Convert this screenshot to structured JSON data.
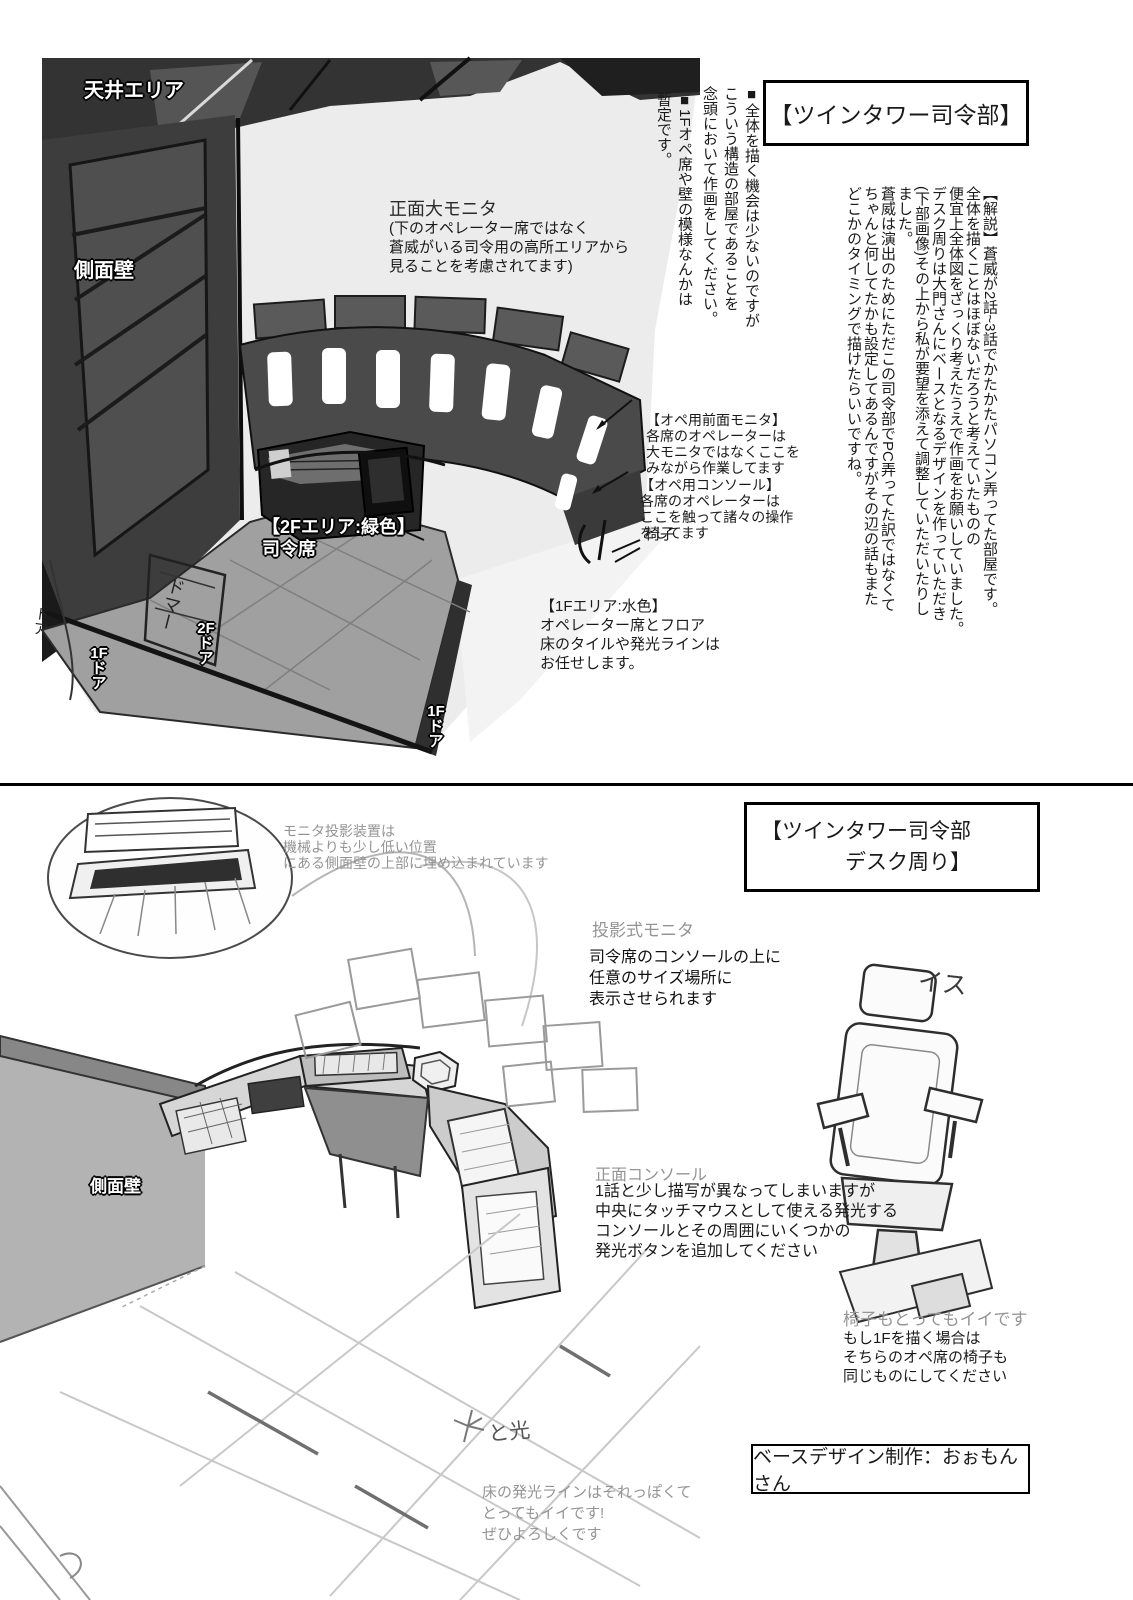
{
  "colors": {
    "ink": "#1a1a1a",
    "note_gray": "#949494",
    "wall_dark": "#3a3a3a",
    "platform_gray": "#a0a0a0",
    "room_light": "#ececec"
  },
  "top_panel": {
    "title": "【ツインタワー司令部】",
    "note_structure": "■全体を描く機会は少ないのですが\nこういう構造の部屋であることを\n念頭において作画をしてください。",
    "note_provisional": "■1Fオペ席や壁の模様なんかは\n暫定です。",
    "commentary": "【解説】蒼威が2話~3話でかたかたパソコン弄ってた部屋です。\n全体を描くことはほぼないだろうと考えていたものの\n便宜上全体図をざっくり考えたうえで作画をお願いしていました。\nデスク周りは大門さんにベースとなるデザインを作っていただき\n(下部画像)その上から私が要望を添えて調整していただいたりし\nました。\n蒼威は演出のためにただこの司令部でPC弄ってた訳ではなくて\nちゃんと何してたかも設定してあるんですがその辺の話もまた\nどこかのタイミングで描けたらいいですね。",
    "labels": {
      "ceiling_area": "天井エリア",
      "side_wall": "側面壁",
      "area_2f": "【2Fエリア:緑色】\n司令席",
      "chair": "椅子",
      "door_2f": "2F\nド\nア",
      "door_1f_left": "1F\nド\nア",
      "door_1f_bottom": "1F\nド\nア",
      "door_handwritten": "ドマー",
      "door_handwritten_left": "ドア"
    },
    "annotations": {
      "main_monitor_title": "正面大モニタ",
      "main_monitor_body": "(下のオペレーター席ではなく\n蒼威がいる司令用の高所エリアから\n見ることを考慮されてます)",
      "op_front_monitor": "【オペ用前面モニタ】\n各席のオペレーターは\n大モニタではなくここを\nみながら作業してます",
      "op_console": "【オペ用コンソール】\n各席のオペレーターは\nここを触って諸々の操作\nをしてます",
      "area_1f": "【1Fエリア:水色】\nオペレーター席とフロア\n床のタイルや発光ラインは\nお任せします。"
    }
  },
  "bottom_panel": {
    "title": "【ツインタワー司令部\n　　　　デスク周り】",
    "labels": {
      "side_wall": "側面壁",
      "chair_sketch": "イス",
      "light_note": "と光"
    },
    "annotations": {
      "projector_device": "モニタ投影装置は\n機械よりも少し低い位置\nにある側面壁の上部に埋め込まれています",
      "projection_monitor_title": "投影式モニタ",
      "projection_monitor_body": "司令席のコンソールの上に\n任意のサイズ場所に\n表示させられます",
      "front_console_title": "正面コンソール",
      "front_console_body": "1話と少し描写が異なってしまいますが\n中央にタッチマウスとして使える発光する\nコンソールとその周囲にいくつかの\n発光ボタンを追加してください",
      "chair_title": "椅子もとってもイイです",
      "chair_body": "もし1Fを描く場合は\nそちらのオペ席の椅子も\n同じものにしてください",
      "floor_line": "床の発光ラインはそれっぽくて\nとってもイイです!\nぜひよろしくです"
    },
    "credit": "ベースデザイン制作：おぉもんさん"
  }
}
